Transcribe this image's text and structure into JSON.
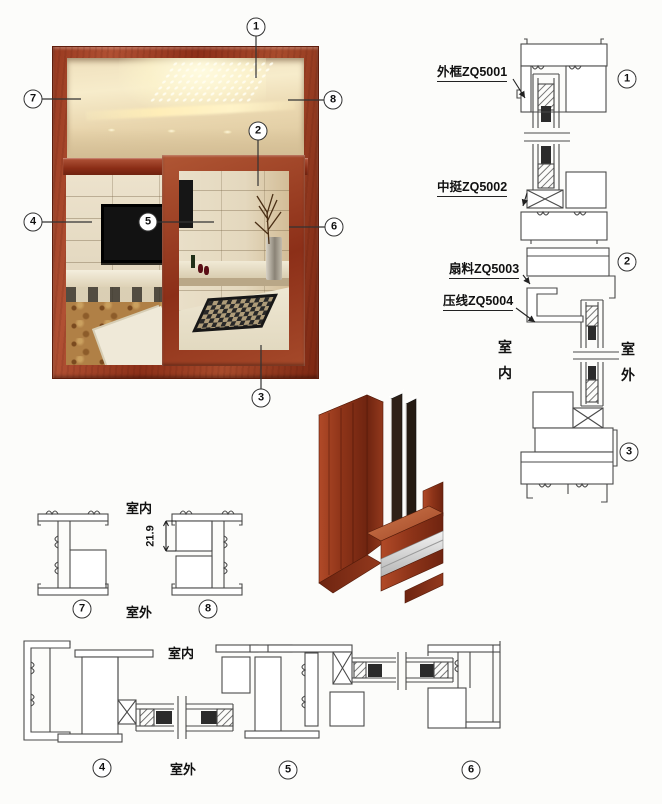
{
  "photo": {
    "callouts": [
      {
        "n": "1"
      },
      {
        "n": "2"
      },
      {
        "n": "3"
      },
      {
        "n": "4"
      },
      {
        "n": "5"
      },
      {
        "n": "6"
      },
      {
        "n": "7"
      },
      {
        "n": "8"
      }
    ]
  },
  "right_diagram": {
    "part_labels": [
      {
        "text": "外框ZQ5001"
      },
      {
        "text": "中挺ZQ5002"
      },
      {
        "text": "扇料ZQ5003"
      },
      {
        "text": "压线ZQ5004"
      }
    ],
    "indoor": "室内",
    "outdoor": "室外",
    "section_markers": [
      {
        "n": "1"
      },
      {
        "n": "2"
      },
      {
        "n": "3"
      }
    ]
  },
  "small_profiles": {
    "indoor": "室内",
    "outdoor": "室外",
    "dimension": "21.9",
    "markers": [
      {
        "n": "7"
      },
      {
        "n": "8"
      }
    ]
  },
  "bottom_sections": {
    "indoor": "室内",
    "outdoor": "室外",
    "markers": [
      {
        "n": "4"
      },
      {
        "n": "5"
      },
      {
        "n": "6"
      }
    ]
  },
  "colors": {
    "line": "#4a4a4a",
    "wood": "#9a3b22",
    "wood_dark": "#7a2a14",
    "wood_light": "#c4744e",
    "glass_seal": "#2b2b2b",
    "background": "#fcfcfa"
  }
}
